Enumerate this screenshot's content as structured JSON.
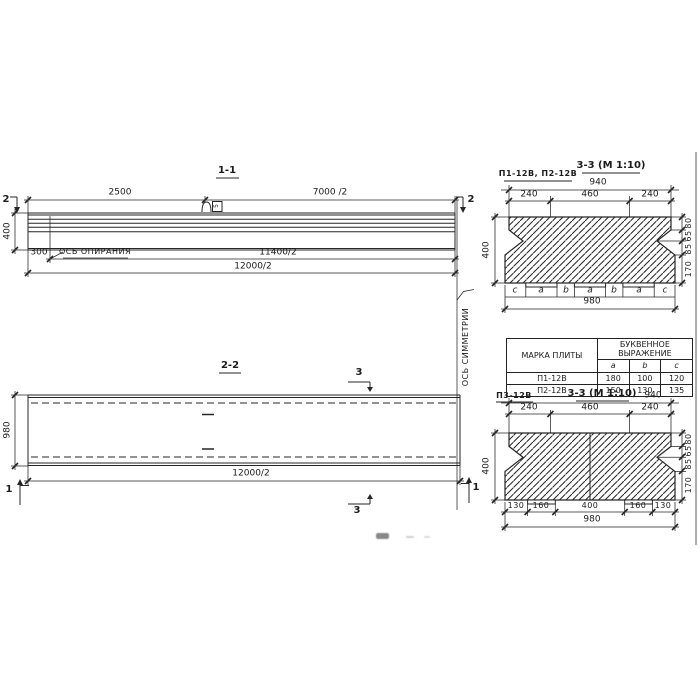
{
  "s11": {
    "title": "1-1",
    "marker2_left": "2",
    "marker2_right": "2",
    "dim_2500": "2500",
    "dim_7000": "7000 /2",
    "dim_400": "400",
    "dim_300": "300",
    "support_axis": "ОСЬ ОПИРАНИЯ",
    "dim_11400": "11400/2",
    "dim_12000": "12000/2",
    "hook_mark": "5"
  },
  "sym_axis": "ОСЬ СИММЕТРИИ",
  "s22": {
    "title": "2-2",
    "dim_980": "980",
    "dim_12000": "12000/2",
    "marker3_top": "3",
    "marker3_bottom": "3",
    "marker1_left": "1",
    "marker1_right": "1"
  },
  "t33": {
    "plates": "П1-12В, П2-12В",
    "title": "3-3 (М 1:10)",
    "dim_940": "940",
    "top_segs": [
      "240",
      "460",
      "240"
    ],
    "dim_400": "400",
    "right_segs": [
      "80",
      "65",
      "85",
      "170"
    ],
    "letters": [
      "c",
      "a",
      "b",
      "a",
      "b",
      "a",
      "c"
    ],
    "dim_980": "980"
  },
  "tbl": {
    "header_mark": "МАРКА ПЛИТЫ",
    "header_expr": "БУКВЕННОЕ ВЫРАЖЕНИЕ",
    "cols": [
      "a",
      "b",
      "c"
    ],
    "rows": [
      {
        "mark": "П1-12В",
        "a": "180",
        "b": "100",
        "c": "120"
      },
      {
        "mark": "П2-12В",
        "a": "150",
        "b": "130",
        "c": "135"
      }
    ]
  },
  "b33": {
    "plate": "П3-12В",
    "title": "3-3 (М 1:10)",
    "dim_940": "940",
    "top_segs": [
      "240",
      "460",
      "240"
    ],
    "dim_400": "400",
    "right_segs": [
      "80",
      "65",
      "85",
      "170"
    ],
    "bottom_segs": [
      "130",
      "160",
      "400",
      "160",
      "130"
    ],
    "dim_980": "980"
  }
}
